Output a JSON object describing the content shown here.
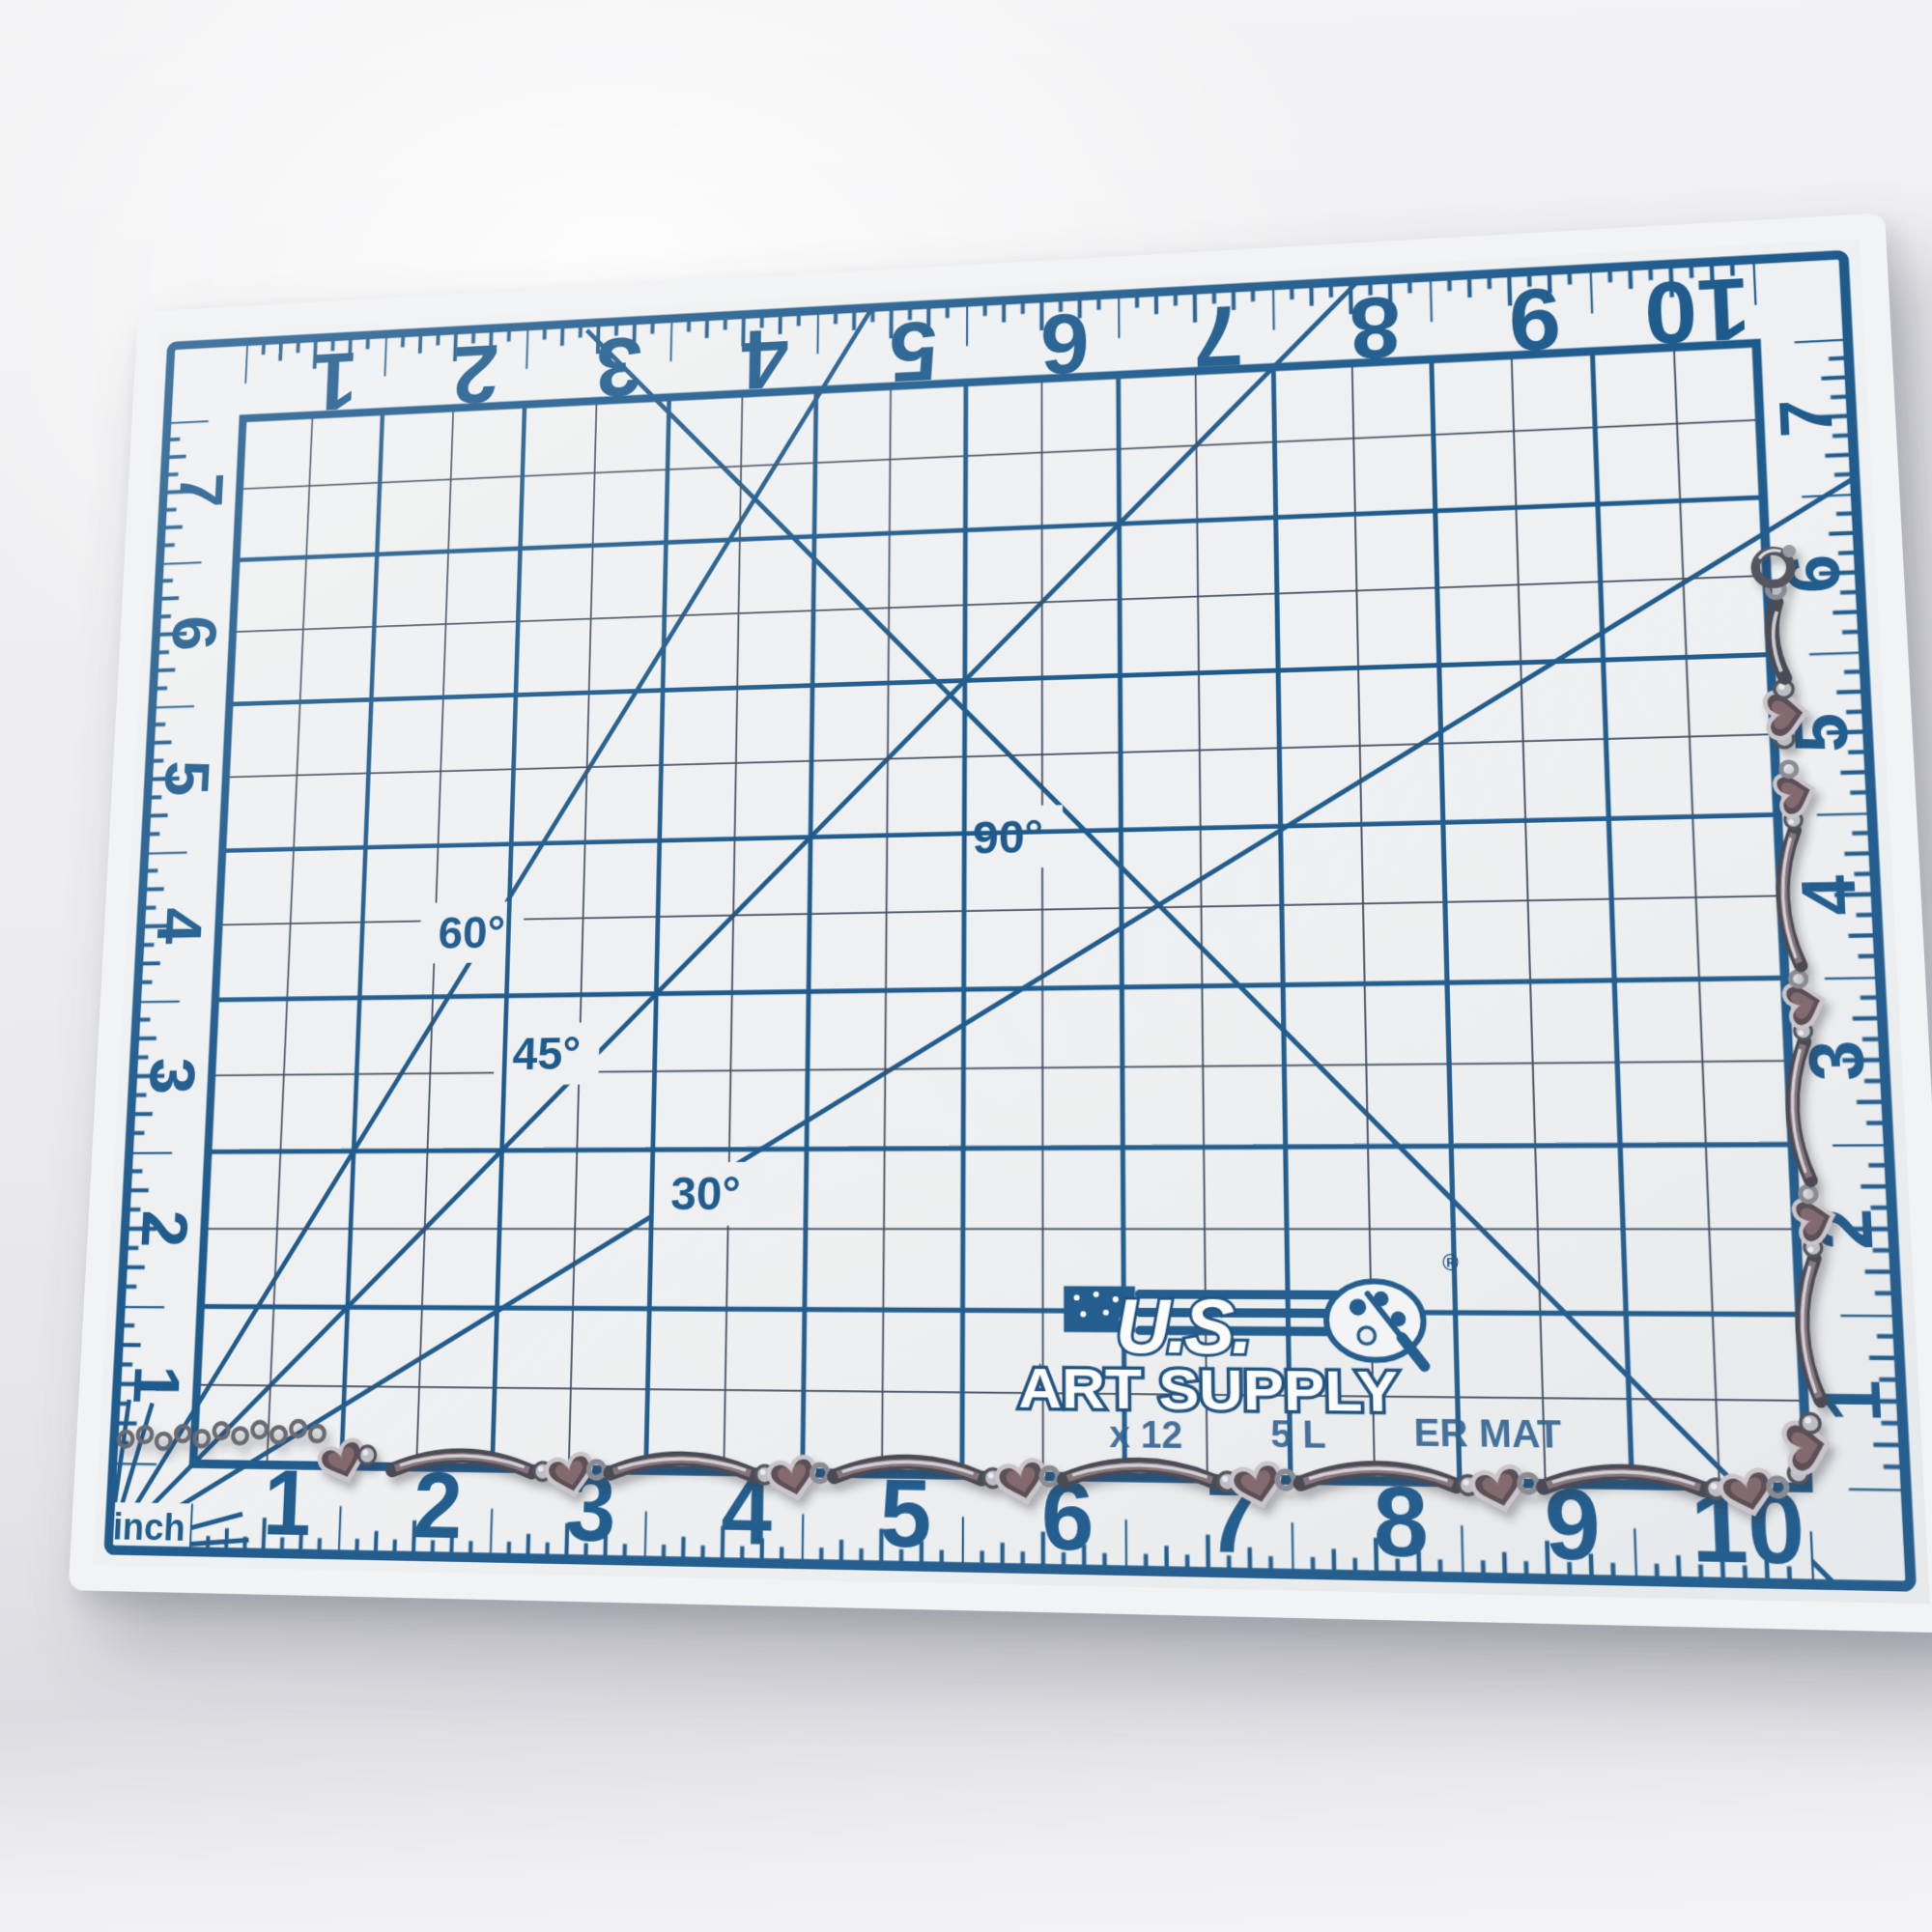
{
  "scene": {
    "subject": "tarnished silver chain with heart and curved-bar links laid in an L-shape along the grid",
    "surface": "blue-printed white measuring cutting mat on a light gray photo backdrop"
  },
  "mat": {
    "brand": {
      "line1": "U.S.",
      "line2": "ART SUPPLY",
      "registered_mark": "®",
      "size_fragment_left": "x 12",
      "size_fragment_mid": "5 L",
      "size_fragment_right": "ER MAT"
    },
    "unit_label": "inch",
    "angle_labels": {
      "deg30": "30°",
      "deg45": "45°",
      "deg60": "60°",
      "deg90": "90°"
    },
    "bottom_numbers": [
      "1",
      "2",
      "3",
      "4",
      "5",
      "6",
      "7",
      "8",
      "9",
      "10"
    ],
    "top_numbers": [
      "1",
      "2",
      "3",
      "4",
      "5",
      "6",
      "7",
      "8",
      "9",
      "10"
    ],
    "left_numbers": [
      "7",
      "6",
      "5",
      "4",
      "3",
      "2",
      "1"
    ],
    "right_numbers": [
      "7",
      "6",
      "5",
      "4",
      "3",
      "2",
      "1"
    ],
    "grid": {
      "columns": 10,
      "rows": 7,
      "minor_interval_inches": 0.5
    },
    "colors": {
      "print_blue": "#1e5a8c",
      "minor_line": "#3f4b5e",
      "mat_surface": "#eef0f1",
      "chain_dark": "#4b4b54",
      "chain_silver": "#bdbdc4",
      "tarnish": "#9b8289"
    }
  }
}
